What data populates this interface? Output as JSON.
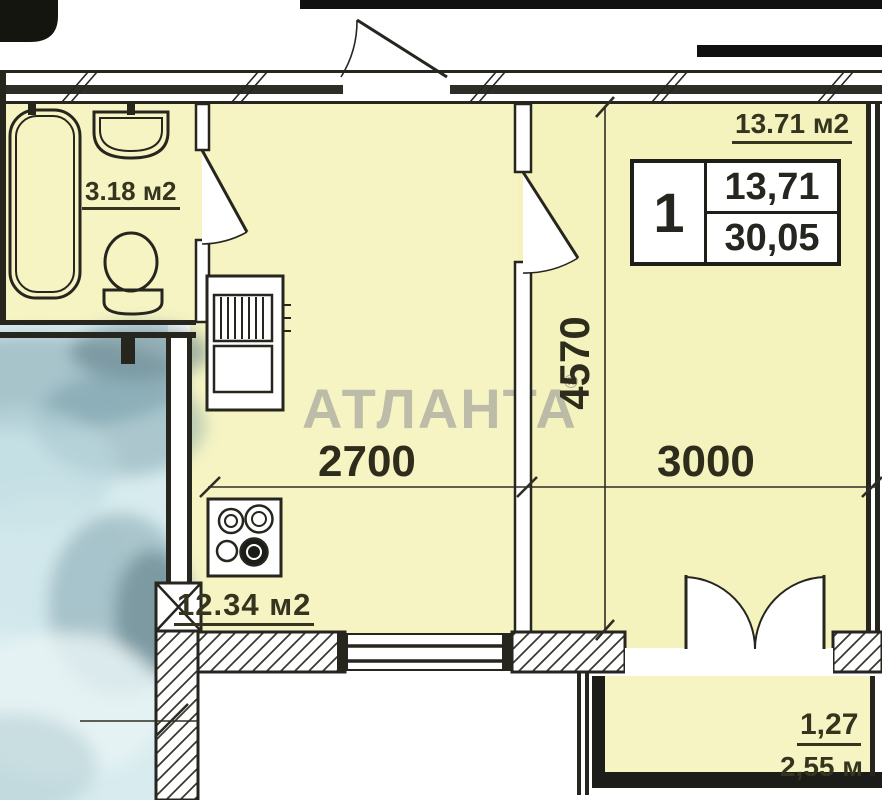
{
  "watermark": {
    "text": "АТЛАНТА",
    "reg": "®"
  },
  "labels": {
    "bathroom_area": "3.18 м2",
    "kitchen_area": "12.34 м2",
    "living_area": "13.71 м2",
    "balcony_coef": "1,27",
    "balcony_len": "2,55 м"
  },
  "dimensions": {
    "kitchen_width": "2700",
    "living_width": "3000",
    "living_depth": "4570"
  },
  "legend": {
    "rooms": "1",
    "living": "13,71",
    "total": "30,05"
  },
  "colors": {
    "room_fill": "#f6f4c3",
    "wall": "#26261f",
    "label": "#35341f",
    "watermark": "#9a9a9a",
    "blur_area": "#d8ecef"
  }
}
